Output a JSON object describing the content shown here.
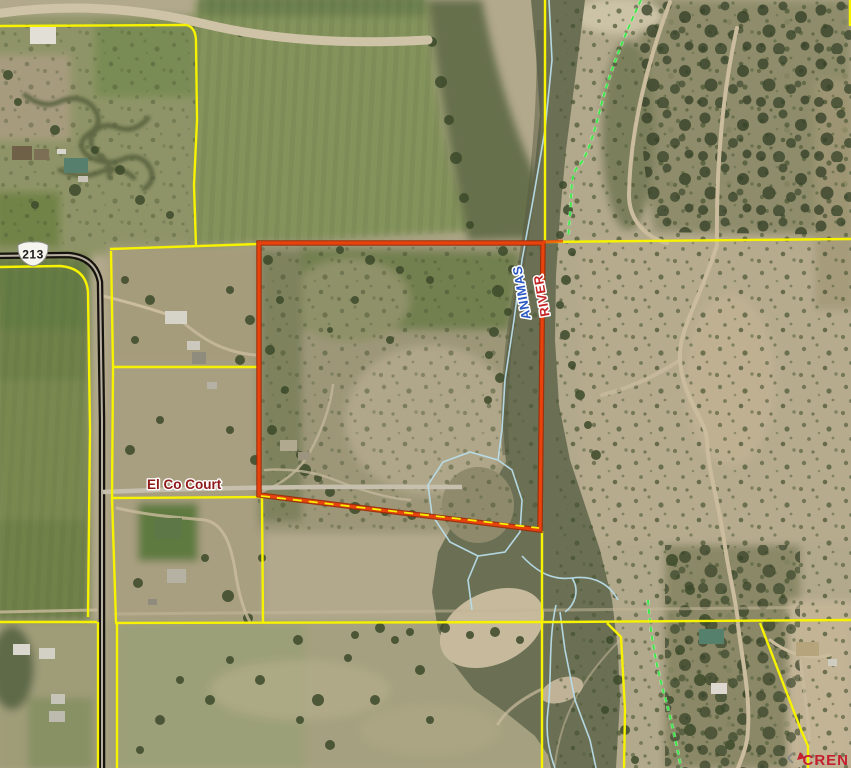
{
  "map": {
    "road_shield_label": "213",
    "street_label": "El Co Court",
    "river_label_word1": "ANIMAS",
    "river_label_word2": "RIVER",
    "watermark_label": "CREN"
  },
  "colors": {
    "parcel_line_yellow": "#f6f200",
    "subject_boundary_red": "#e8430d",
    "subject_boundary_red_halo": "#9e2a06",
    "water_outline_blue": "#b8dde9",
    "overlay_dash_green": "#3fe84b",
    "highway_black": "#17140f",
    "street_label_red": "#8e1717",
    "river_label_blue": "#2b59c3",
    "river_label_red": "#c42424",
    "watermark_red": "#c41f2e",
    "shield_text_black": "#1a1a1a"
  }
}
